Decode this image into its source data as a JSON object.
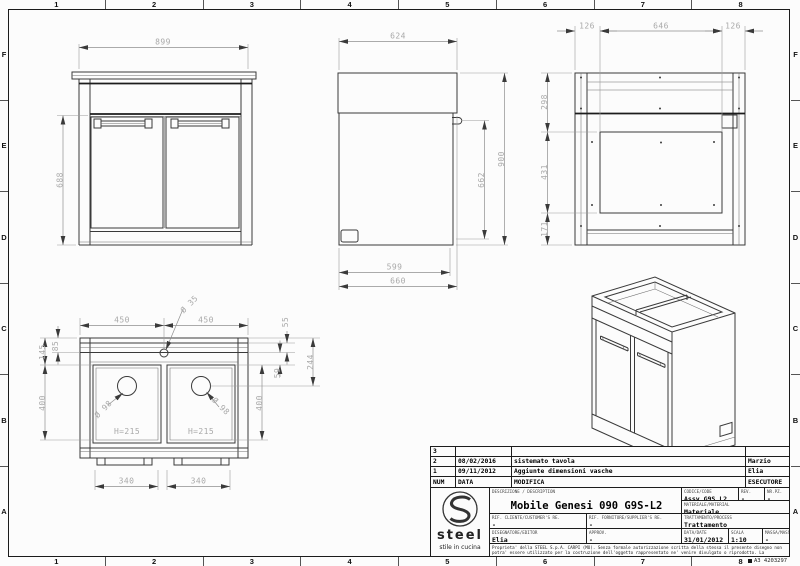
{
  "sheet": {
    "format_code": "A3 4203297"
  },
  "grid": {
    "cols": [
      "1",
      "2",
      "3",
      "4",
      "5",
      "6",
      "7",
      "8"
    ],
    "rows": [
      "F",
      "E",
      "D",
      "C",
      "B",
      "A"
    ]
  },
  "views": {
    "front": {
      "width": "899",
      "height": "688"
    },
    "side": {
      "top_depth": "624",
      "total_height": "900",
      "side_height": "662",
      "inner_depth": "599",
      "total_depth": "660"
    },
    "rear": {
      "left_offset": "126",
      "back_width": "646",
      "right_offset": "126",
      "top_height": "298",
      "mid_height": "431",
      "bottom_height": "171"
    },
    "plan": {
      "left_width": "450",
      "right_width": "450",
      "tap_hole": "Ø 35",
      "back_gap": "55",
      "edge_front": "145",
      "edge_back": "85",
      "rim_gap": "59",
      "drain_offset": "244",
      "left_depth": "400",
      "right_depth": "400",
      "left_drain": "Ø 98",
      "right_drain": "Ø 98",
      "left_basin_h": "H=215",
      "right_basin_h": "H=215",
      "left_feet": "340",
      "right_feet": "340"
    }
  },
  "revisions": {
    "header": {
      "num": "NUM",
      "date": "DATA",
      "change": "MODIFICA",
      "author": "ESECUTORE"
    },
    "rows": [
      {
        "num": "3",
        "date": "",
        "change": "",
        "author": ""
      },
      {
        "num": "2",
        "date": "08/02/2016",
        "change": "sistemato tavola",
        "author": "Marzio"
      },
      {
        "num": "1",
        "date": "09/11/2012",
        "change": "Aggiunte dimensioni vasche",
        "author": "Elia"
      }
    ]
  },
  "title_block": {
    "description_label": "DESCRIZIONE / DESCRIPTION",
    "description": "Mobile Genesi 090 G9S-L2",
    "code_label": "CODICE/CODE",
    "code": "Assy G9S L2",
    "rev_label": "REV.",
    "rev": "-",
    "qty_label": "NR.PZ.",
    "qty": "-",
    "material_label": "MATERIALE/MATERIAL",
    "material": "Materiale",
    "customer_ref_label": "RIF. CLIENTE/CUSTOMER'S RE.",
    "customer_ref": "-",
    "supplier_ref_label": "RIF. FORNITORE/SUPPLIER'S RE.",
    "supplier_ref": "-",
    "process_label": "TRATTAMENTO/PROCESS",
    "process": "Trattamento",
    "drafter_label": "DISEGNATORE/EDITOR",
    "drafter": "Elia",
    "approval_label": "APPROV.",
    "approval": "-",
    "date_label": "DATA/DATE",
    "date": "31/01/2012",
    "scale_label": "SCALA",
    "scale": "1:10",
    "mass_label": "MASSA/MASS kg",
    "mass": "-",
    "disclaimer": "Proprieta' della STEEL S.p.A. CARPI (MO). Senza formale autorizzazione scritta della stessa il presente disegno non potra' essere utilizzato per la costruzione dell'oggetto rappresentato ne' venire divulgato o riprodotto. La proprietaria tutela i propri diritti a rigore di legge.",
    "logo": {
      "brand": "steel",
      "tagline": "stile in cucina"
    }
  }
}
